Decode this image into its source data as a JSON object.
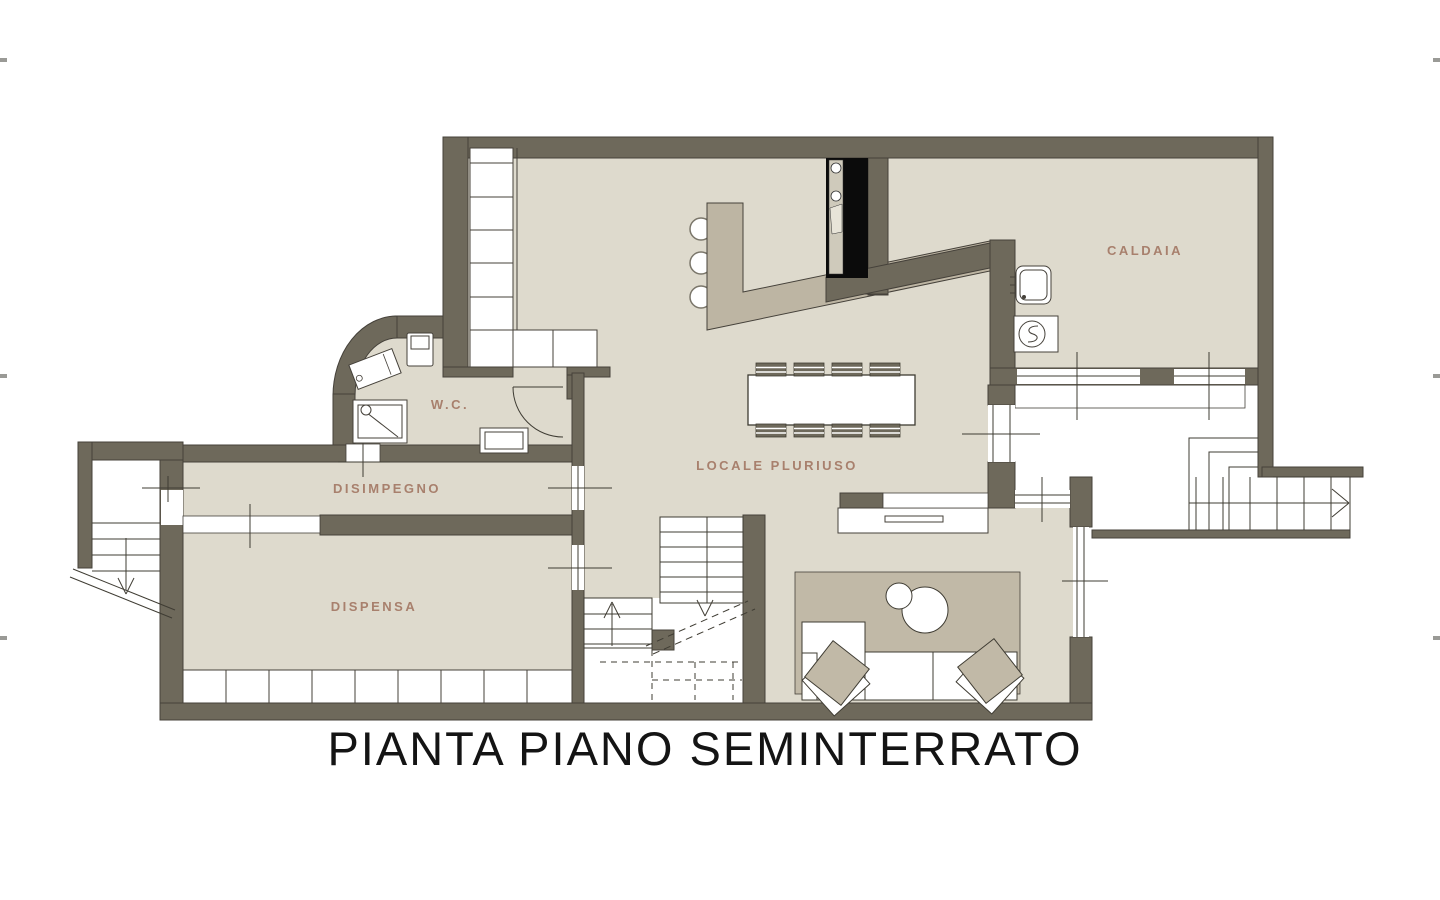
{
  "title": "PIANTA PIANO SEMINTERRATO",
  "rooms": {
    "caldaia": "CALDAIA",
    "wc": "W.C.",
    "disimpegno": "DISIMPEGNO",
    "dispensa": "DISPENSA",
    "locale_pluriuso": "LOCALE PLURIUSO"
  },
  "colors": {
    "background": "#ffffff",
    "wall": "#6e695b",
    "floor": "#dedacd",
    "accent_taupe": "#c1b9a7",
    "counter_taupe": "#bdb5a3",
    "label_text": "#a8806d",
    "title_text": "#141414",
    "line": "#3f3c33",
    "fireplace_black": "#0b0b0b"
  },
  "features": [
    "fireplace-icon",
    "bar-counter",
    "bar-stools",
    "dining-table-8-chairs",
    "wardrobe-cabinets",
    "shower-icon",
    "toilet-icon",
    "washbasin-icon",
    "boiler-icon",
    "sink-icon",
    "sofa",
    "cushions",
    "rug",
    "side-tables",
    "sideboard",
    "internal-staircase",
    "external-staircase-right",
    "external-staircase-left",
    "pantry-shelving",
    "door-swing",
    "windows"
  ]
}
